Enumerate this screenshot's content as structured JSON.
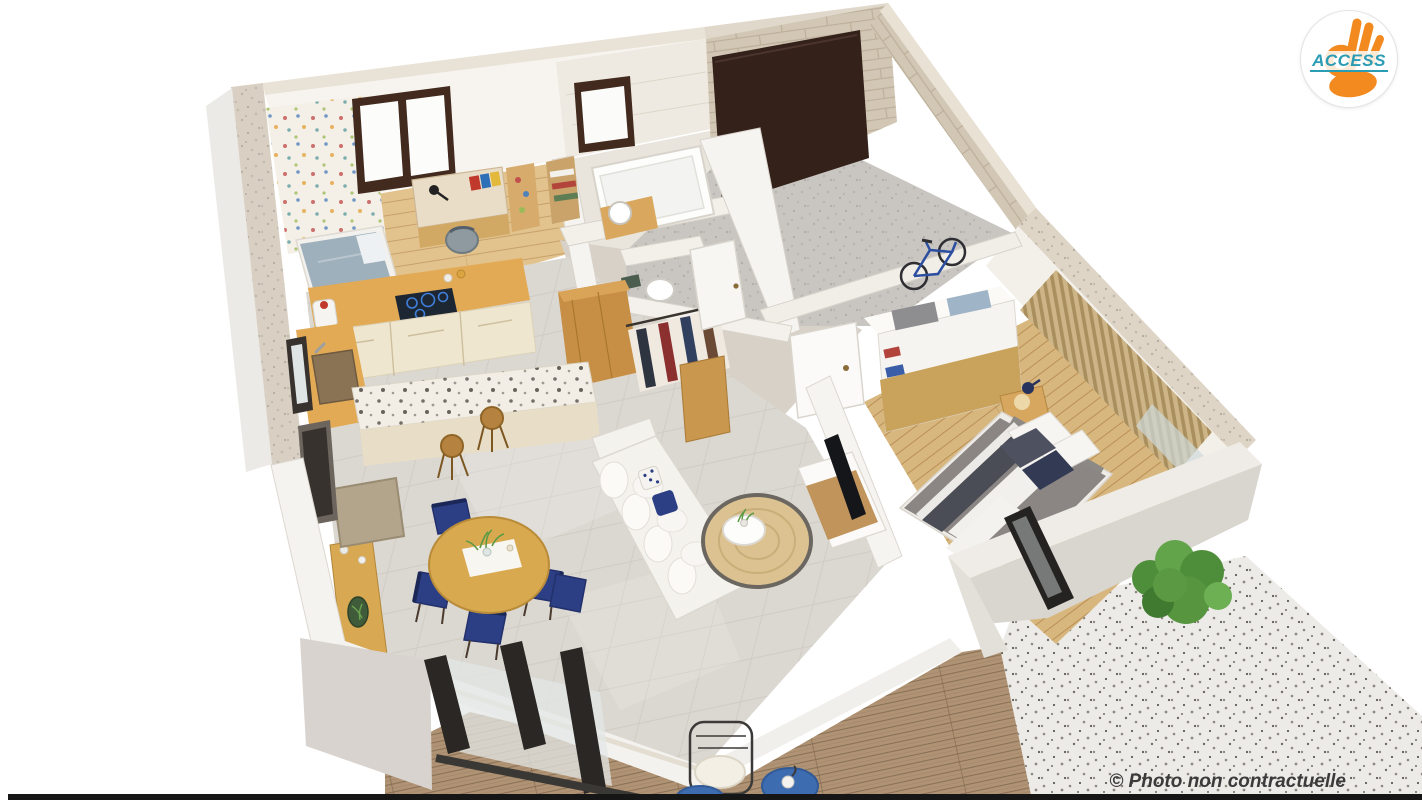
{
  "page": {
    "width": 1422,
    "height": 800,
    "background": "#ffffff"
  },
  "branding": {
    "logo_text": "ACCESS",
    "logo_text_color": "#2a9cb4",
    "logo_hand_color": "#f28a20",
    "logo_circle_color": "#ffffff",
    "logo_border_color": "#e3e3e3"
  },
  "watermark": {
    "text": "© Photo non contractuelle",
    "color": "#3b3b3b"
  },
  "scene": {
    "description": "3D isometric cutaway render of a single-storey house floor plan",
    "rooms": [
      "kids-bedroom",
      "kitchen",
      "bathroom",
      "wc",
      "walk-in-closet",
      "hallway",
      "garage",
      "laundry-storage",
      "master-bedroom",
      "living-room",
      "dining-area",
      "terrace"
    ],
    "colors": {
      "wall": "#f7f4f0",
      "wall_top": "#e9e2d6",
      "wall_shadow": "#d9d4ce",
      "stone": "#d2c7b5",
      "wood_floor": "#e2c38d",
      "wood_floor2": "#d8b77f",
      "tile_floor": "#dbd7d1",
      "garage_floor": "#c9c6c2",
      "deck": "#b09374",
      "gravel": "#edebe7",
      "counter_wood": "#e2aa55",
      "cabinet_cream": "#efe6d0",
      "island_top": "#f2eee5",
      "dark_frame": "#33211a",
      "navy": "#2c3f85",
      "rug": "#dcc290",
      "rug_border": "#6b6760",
      "sofa": "#f4f2ed",
      "bed_gray": "#8b8683",
      "plant": "#5b9a43"
    }
  }
}
